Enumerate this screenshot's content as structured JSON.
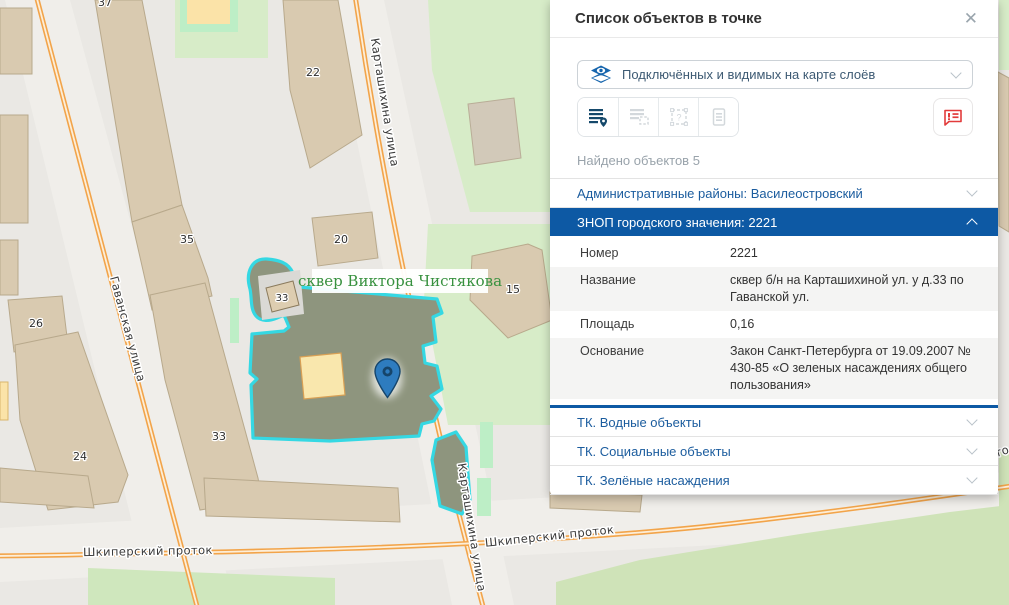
{
  "panel": {
    "title": "Список объектов в точке",
    "close": "✕",
    "layers_dropdown": {
      "value": "Подключённых и видимых на карте слоёв"
    },
    "found_text": "Найдено объектов 5",
    "icons": {
      "dropdown": "layers-eye-icon",
      "tool_1": "list-point-icon",
      "tool_2": "list-area-icon",
      "tool_3": "area-question-icon",
      "tool_4": "document-icon",
      "report": "report-bubble-icon",
      "close": "close-icon"
    },
    "accordions": [
      {
        "label": "Административные районы: Василеостровский",
        "state": "collapsed"
      },
      {
        "label": "ЗНОП городского значения: 2221",
        "state": "expanded"
      },
      {
        "label": "ТК. Водные объекты",
        "state": "collapsed"
      },
      {
        "label": "ТК. Социальные объекты",
        "state": "collapsed"
      },
      {
        "label": "ТК. Зелёные насаждения",
        "state": "collapsed"
      }
    ],
    "details": {
      "rows": [
        {
          "label": "Номер",
          "value": "2221"
        },
        {
          "label": "Название",
          "value": "сквер б/н на Карташихиной ул. у д.33 по Гаванской ул."
        },
        {
          "label": "Площадь",
          "value": "0,16"
        },
        {
          "label": "Основание",
          "value": "Закон Санкт-Петербурга от 19.09.2007 № 430-85 «О зеленых насаждениях общего пользования»"
        }
      ]
    }
  },
  "map": {
    "area_label": "сквер Виктора Чистякова",
    "streets": {
      "gavanskaya": "Гаванская улица",
      "kartashikhina_top": "Карташихина улица",
      "kartashikhina_bottom": "Карташихина улица",
      "shkipersky_left": "Шкиперский проток",
      "shkipersky_right": "Шкиперский проток",
      "edge_fragment": "то"
    },
    "buildings": {
      "b37": "37",
      "b35": "35",
      "b22": "22",
      "b20": "20",
      "b15": "15",
      "b26": "26",
      "b24": "24",
      "b33_street": "33",
      "b33_inner": "33"
    },
    "colors": {
      "accent_blue": "#0d59a4",
      "link_blue": "#1b5c9e",
      "danger_red": "#e23b3b",
      "outline_cyan": "#35d8e3",
      "square_fill": "#8e957e",
      "road_orange": "#f2a44a",
      "area_label_green": "#38913f",
      "pin_blue": "#2e7cbf",
      "building_tan": "#d9cab0",
      "green_area": "#d7ecc8"
    }
  }
}
